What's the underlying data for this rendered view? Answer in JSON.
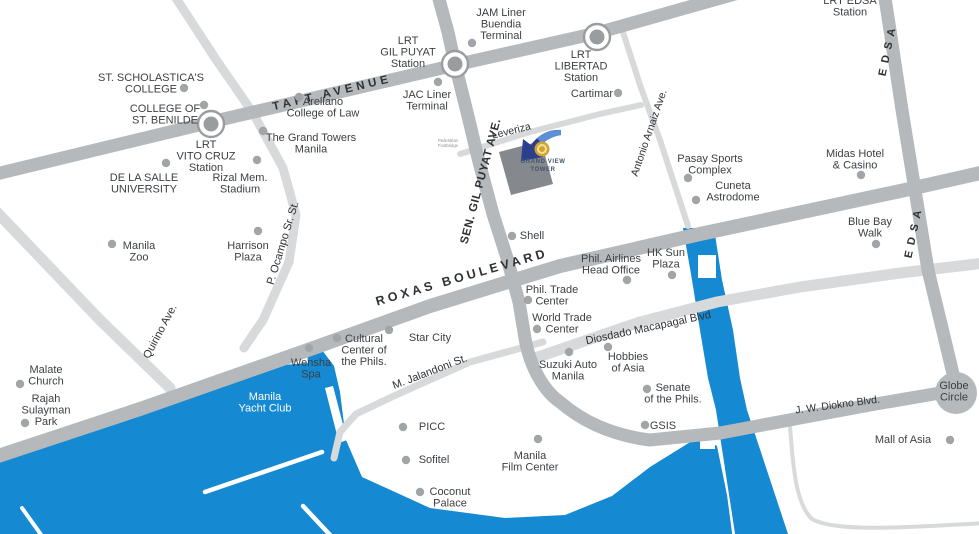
{
  "map": {
    "title": "Grand View Tower vicinity map",
    "colors": {
      "water": "#1589d1",
      "road_major": "#b6b9bc",
      "road_minor": "#d7d9db",
      "dot": "#a2a5a8",
      "text": "#3c3f42",
      "road_text": "#2e3134",
      "station_ring": "#9a9da0",
      "logo_gold": "#d2a42e",
      "logo_gold_light": "#f3dfa0",
      "logo_navy": "#2b3f8c",
      "logo_blue": "#5b8fd6",
      "logo_square": "#85898d",
      "logo_text": "#46536e"
    },
    "logo": {
      "lines": [
        "GRAND VIEW",
        "TOWER"
      ]
    },
    "road_labels": [
      {
        "id": "taft-avenue",
        "text": "TAFT AVENUE",
        "x": 333,
        "y": 96,
        "rot": -13.5,
        "size": 11.5,
        "weight": "bold",
        "ls": 4
      },
      {
        "id": "sen-gil-puyat-ave",
        "text": "SEN. GIL PUYAT AVE.",
        "x": 484,
        "y": 182,
        "rot": -75,
        "size": 11.5,
        "weight": "bold",
        "ls": 0.6
      },
      {
        "id": "roxas-boulevard",
        "text": "ROXAS BOULEVARD",
        "x": 463,
        "y": 281,
        "rot": -16,
        "size": 12.5,
        "weight": "bold",
        "ls": 3.5
      },
      {
        "id": "edsa-north",
        "text": "EDSA",
        "x": 891,
        "y": 50,
        "rot": -78,
        "size": 11,
        "weight": "bold",
        "ls": 6
      },
      {
        "id": "edsa-south",
        "text": "EDSA",
        "x": 917,
        "y": 232,
        "rot": -78,
        "size": 11,
        "weight": "bold",
        "ls": 6
      },
      {
        "id": "leveriza",
        "text": "Leveriza",
        "x": 512,
        "y": 134,
        "rot": -14,
        "size": 10.5,
        "weight": "normal",
        "ls": 0
      },
      {
        "id": "antonio-arnaiz-ave",
        "text": "Antonio Arnaiz Ave.",
        "x": 652,
        "y": 134,
        "rot": -71,
        "size": 10.5,
        "weight": "normal",
        "ls": 0
      },
      {
        "id": "p-ocampo-sr-st",
        "text": "P. Ocampo Sr. St.",
        "x": 286,
        "y": 244,
        "rot": -73,
        "size": 11,
        "weight": "normal",
        "ls": 0
      },
      {
        "id": "quirino-ave",
        "text": "Quirino Ave.",
        "x": 163,
        "y": 333,
        "rot": -62,
        "size": 11,
        "weight": "normal",
        "ls": 0
      },
      {
        "id": "diosdado-macapagal-blvd",
        "text": "Diosdado Macapagal Blvd",
        "x": 649,
        "y": 331,
        "rot": -12,
        "size": 11,
        "weight": "normal",
        "ls": 0
      },
      {
        "id": "jw-diokno-blvd",
        "text": "J. W. Diokno Blvd.",
        "x": 838,
        "y": 408,
        "rot": -7.5,
        "size": 10.5,
        "weight": "normal",
        "ls": 0
      },
      {
        "id": "m-jalandoni-st",
        "text": "M. Jalandoni St.",
        "x": 431,
        "y": 375,
        "rot": -21,
        "size": 11,
        "weight": "normal",
        "ls": 0
      }
    ],
    "stations": [
      {
        "id": "lrt-vito-cruz-marker",
        "x": 211,
        "y": 124
      },
      {
        "id": "lrt-gil-puyat-marker",
        "x": 455,
        "y": 64
      },
      {
        "id": "lrt-libertad-marker",
        "x": 597,
        "y": 37
      }
    ],
    "globe_circle": {
      "x": 956,
      "y": 393,
      "r": 21
    },
    "pois": [
      {
        "id": "st-scholasticas-college",
        "lines": [
          "ST. SCHOLASTICA'S",
          "COLLEGE"
        ],
        "x": 151,
        "y": 81,
        "dot": {
          "x": 184,
          "y": 88
        }
      },
      {
        "id": "college-of-st-benilde",
        "lines": [
          "COLLEGE OF",
          "ST. BENILDE"
        ],
        "x": 165,
        "y": 112,
        "dot": {
          "x": 204,
          "y": 105
        }
      },
      {
        "id": "lrt-vito-cruz-station",
        "lines": [
          "LRT",
          "VITO CRUZ",
          "Station"
        ],
        "x": 206,
        "y": 148
      },
      {
        "id": "de-la-salle-university",
        "lines": [
          "DE LA SALLE",
          "UNIVERSITY"
        ],
        "x": 144,
        "y": 181,
        "dot": {
          "x": 166,
          "y": 163
        }
      },
      {
        "id": "rizal-mem-stadium",
        "lines": [
          "Rizal Mem.",
          "Stadium"
        ],
        "x": 240,
        "y": 181,
        "dot": {
          "x": 257,
          "y": 160
        }
      },
      {
        "id": "the-grand-towers-manila",
        "lines": [
          "The Grand Towers",
          "Manila"
        ],
        "x": 311,
        "y": 141,
        "dot": {
          "x": 263,
          "y": 131
        }
      },
      {
        "id": "arellano-college-of-law",
        "lines": [
          "Arellano",
          "College of Law"
        ],
        "x": 323,
        "y": 105,
        "dot": {
          "x": 299,
          "y": 97
        }
      },
      {
        "id": "manila-zoo",
        "lines": [
          "Manila",
          "Zoo"
        ],
        "x": 139,
        "y": 249,
        "dot": {
          "x": 112,
          "y": 244
        }
      },
      {
        "id": "harrison-plaza",
        "lines": [
          "Harrison",
          "Plaza"
        ],
        "x": 248,
        "y": 249,
        "dot": {
          "x": 258,
          "y": 231
        }
      },
      {
        "id": "malate-church",
        "lines": [
          "Malate",
          "Church"
        ],
        "x": 46,
        "y": 373,
        "dot": {
          "x": 20,
          "y": 384
        }
      },
      {
        "id": "rajah-sulayman-park",
        "lines": [
          "Rajah",
          "Sulayman",
          "Park"
        ],
        "x": 46,
        "y": 402,
        "dot": {
          "x": 25,
          "y": 423
        }
      },
      {
        "id": "wensha-spa",
        "lines": [
          "Wensha",
          "Spa"
        ],
        "x": 311,
        "y": 366,
        "dot": {
          "x": 309,
          "y": 348
        }
      },
      {
        "id": "manila-yacht-club",
        "lines": [
          "Manila",
          "Yacht Club"
        ],
        "x": 265,
        "y": 400,
        "color": "#ffffff"
      },
      {
        "id": "jam-liner-buendia-terminal",
        "lines": [
          "JAM Liner",
          "Buendia",
          "Terminal"
        ],
        "x": 501,
        "y": 16,
        "dot": {
          "x": 472,
          "y": 43
        }
      },
      {
        "id": "lrt-gil-puyat-station",
        "lines": [
          "LRT",
          "GIL PUYAT",
          "Station"
        ],
        "x": 408,
        "y": 44
      },
      {
        "id": "jac-liner-terminal",
        "lines": [
          "JAC Liner",
          "Terminal"
        ],
        "x": 427,
        "y": 98,
        "dot": {
          "x": 438,
          "y": 82
        }
      },
      {
        "id": "lrt-libertad-station",
        "lines": [
          "LRT",
          "LIBERTAD",
          "Station"
        ],
        "x": 581,
        "y": 58
      },
      {
        "id": "cartimar",
        "lines": [
          "Cartimar"
        ],
        "x": 592,
        "y": 97,
        "dot": {
          "x": 618,
          "y": 93
        }
      },
      {
        "id": "lrt-edsa-station",
        "lines": [
          "LRT EDSA",
          "Station"
        ],
        "x": 850,
        "y": 4
      },
      {
        "id": "pasay-sports-complex",
        "lines": [
          "Pasay Sports",
          "Complex"
        ],
        "x": 710,
        "y": 162,
        "dot": {
          "x": 688,
          "y": 178
        }
      },
      {
        "id": "cuneta-astrodome",
        "lines": [
          "Cuneta",
          "Astrodome"
        ],
        "x": 733,
        "y": 189,
        "dot": {
          "x": 696,
          "y": 200
        }
      },
      {
        "id": "midas-hotel-casino",
        "lines": [
          "Midas Hotel",
          "& Casino"
        ],
        "x": 855,
        "y": 157,
        "dot": {
          "x": 861,
          "y": 175
        }
      },
      {
        "id": "blue-bay-walk",
        "lines": [
          "Blue Bay",
          "Walk"
        ],
        "x": 870,
        "y": 225,
        "dot": {
          "x": 876,
          "y": 244
        }
      },
      {
        "id": "shell",
        "lines": [
          "Shell"
        ],
        "x": 532,
        "y": 239,
        "dot": {
          "x": 512,
          "y": 236
        }
      },
      {
        "id": "hk-sun-plaza",
        "lines": [
          "HK Sun",
          "Plaza"
        ],
        "x": 666,
        "y": 256,
        "dot": {
          "x": 672,
          "y": 275
        }
      },
      {
        "id": "phil-airlines-head-office",
        "lines": [
          "Phil. Airlines",
          "Head Office"
        ],
        "x": 611,
        "y": 262,
        "dot": {
          "x": 627,
          "y": 280
        }
      },
      {
        "id": "phil-trade-center",
        "lines": [
          "Phil. Trade",
          "Center"
        ],
        "x": 552,
        "y": 293,
        "dot": {
          "x": 528,
          "y": 300
        }
      },
      {
        "id": "world-trade-center",
        "lines": [
          "World Trade",
          "Center"
        ],
        "x": 562,
        "y": 321,
        "dot": {
          "x": 537,
          "y": 329
        }
      },
      {
        "id": "star-city",
        "lines": [
          "Star City"
        ],
        "x": 430,
        "y": 341,
        "dot": {
          "x": 389,
          "y": 330
        }
      },
      {
        "id": "cultural-center-of-the-phils",
        "lines": [
          "Cultural",
          "Center of",
          "the Phils."
        ],
        "x": 364,
        "y": 342,
        "dot": {
          "x": 337,
          "y": 338
        }
      },
      {
        "id": "suzuki-auto-manila",
        "lines": [
          "Suzuki Auto",
          "Manila"
        ],
        "x": 568,
        "y": 368,
        "dot": {
          "x": 569,
          "y": 352
        }
      },
      {
        "id": "hobbies-of-asia",
        "lines": [
          "Hobbies",
          "of Asia"
        ],
        "x": 628,
        "y": 360,
        "dot": {
          "x": 608,
          "y": 347
        }
      },
      {
        "id": "senate-of-the-phils",
        "lines": [
          "Senate",
          "of the Phils."
        ],
        "x": 673,
        "y": 391,
        "dot": {
          "x": 647,
          "y": 389
        }
      },
      {
        "id": "gsis",
        "lines": [
          "GSIS"
        ],
        "x": 663,
        "y": 429,
        "dot": {
          "x": 645,
          "y": 425
        }
      },
      {
        "id": "picc",
        "lines": [
          "PICC"
        ],
        "x": 432,
        "y": 430,
        "dot": {
          "x": 403,
          "y": 427
        }
      },
      {
        "id": "sofitel",
        "lines": [
          "Sofitel"
        ],
        "x": 434,
        "y": 463,
        "dot": {
          "x": 406,
          "y": 460
        }
      },
      {
        "id": "coconut-palace",
        "lines": [
          "Coconut",
          "Palace"
        ],
        "x": 450,
        "y": 495,
        "dot": {
          "x": 420,
          "y": 492
        }
      },
      {
        "id": "manila-film-center",
        "lines": [
          "Manila",
          "Film Center"
        ],
        "x": 530,
        "y": 459,
        "dot": {
          "x": 538,
          "y": 439
        }
      },
      {
        "id": "mall-of-asia",
        "lines": [
          "Mall of Asia"
        ],
        "x": 903,
        "y": 443,
        "dot": {
          "x": 950,
          "y": 440
        }
      },
      {
        "id": "globe-circle",
        "lines": [
          "Globe",
          "Circle"
        ],
        "x": 954,
        "y": 389
      },
      {
        "id": "pedestrian-footbridge-note",
        "lines": [
          "Pedestrian",
          "Footbridge"
        ],
        "x": 448,
        "y": 142,
        "size": 4.2,
        "lh": 5,
        "color": "#8a8d90"
      },
      {
        "id": "grand-view-tower-label",
        "lines": [
          "GRAND VIEW",
          "TOWER"
        ],
        "x": 543,
        "y": 163,
        "size": 6,
        "lh": 8,
        "weight": "bold",
        "ls": 0.6,
        "color": "#46536e"
      }
    ]
  }
}
